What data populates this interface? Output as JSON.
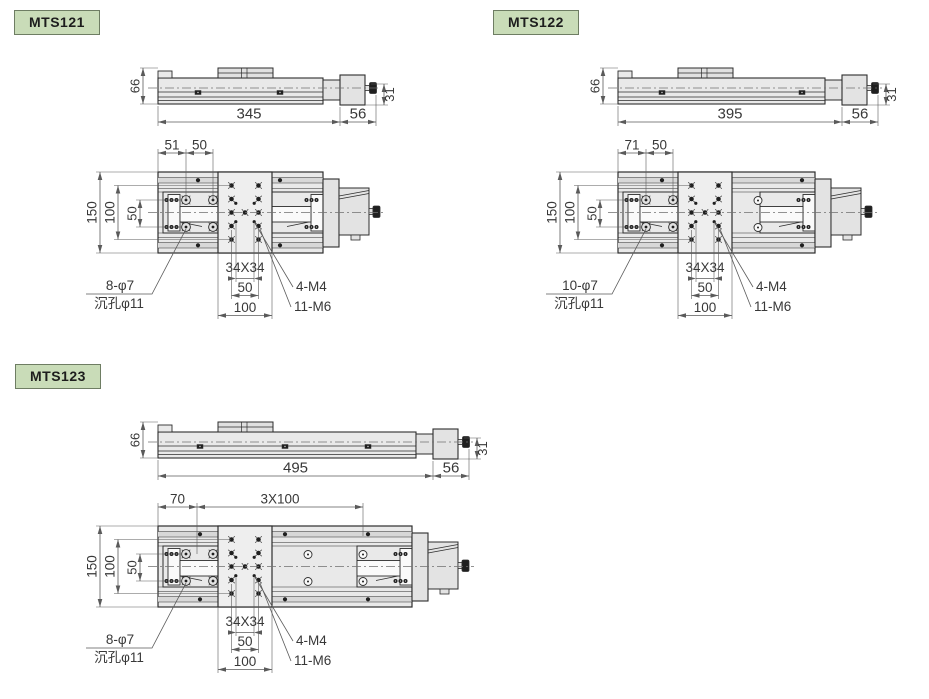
{
  "page_title": "MTS motorized translation stage dimension drawings",
  "colors": {
    "background": "#ffffff",
    "badge_fill": "#c9dcb8",
    "badge_border": "#6e7d63",
    "line": "#2d2d2d",
    "dim_line": "#5a5a5a",
    "dim_text": "#383838",
    "body_fill": "#e9e9e9",
    "stripe_fill": "#d8d8d8",
    "stripe_fill2": "#e0e0e0",
    "platform_fill": "#eeeeee",
    "white_fill": "#fafafa",
    "dark_fill": "#1f1f1f",
    "hardware_fill": "#e3e3e3"
  },
  "panels": [
    {
      "model": "MTS121",
      "side_view": {
        "overall_height": "66",
        "body_length": "345",
        "end_length": "56",
        "end_height": "31"
      },
      "top_view": {
        "top_dims": [
          "51",
          "50"
        ],
        "left_dims": [
          "150",
          "100",
          "50"
        ],
        "bottom_dims": [
          "34X34",
          "50",
          "100"
        ],
        "callouts": {
          "mount_holes": "8-φ7",
          "counterbore": "沉孔φ11",
          "m4_holes": "4-M4",
          "m6_holes": "11-M6"
        }
      }
    },
    {
      "model": "MTS122",
      "side_view": {
        "overall_height": "66",
        "body_length": "395",
        "end_length": "56",
        "end_height": "31"
      },
      "top_view": {
        "top_dims": [
          "71",
          "50"
        ],
        "left_dims": [
          "150",
          "100",
          "50"
        ],
        "bottom_dims": [
          "34X34",
          "50",
          "100"
        ],
        "callouts": {
          "mount_holes": "10-φ7",
          "counterbore": "沉孔φ11",
          "m4_holes": "4-M4",
          "m6_holes": "11-M6"
        }
      }
    },
    {
      "model": "MTS123",
      "side_view": {
        "overall_height": "66",
        "body_length": "495",
        "end_length": "56",
        "end_height": "31"
      },
      "top_view": {
        "top_dims": [
          "70",
          "3X100"
        ],
        "left_dims": [
          "150",
          "100",
          "50"
        ],
        "bottom_dims": [
          "34X34",
          "50",
          "100"
        ],
        "callouts": {
          "mount_holes": "8-φ7",
          "counterbore": "沉孔φ11",
          "m4_holes": "4-M4",
          "m6_holes": "11-M6"
        }
      }
    }
  ]
}
